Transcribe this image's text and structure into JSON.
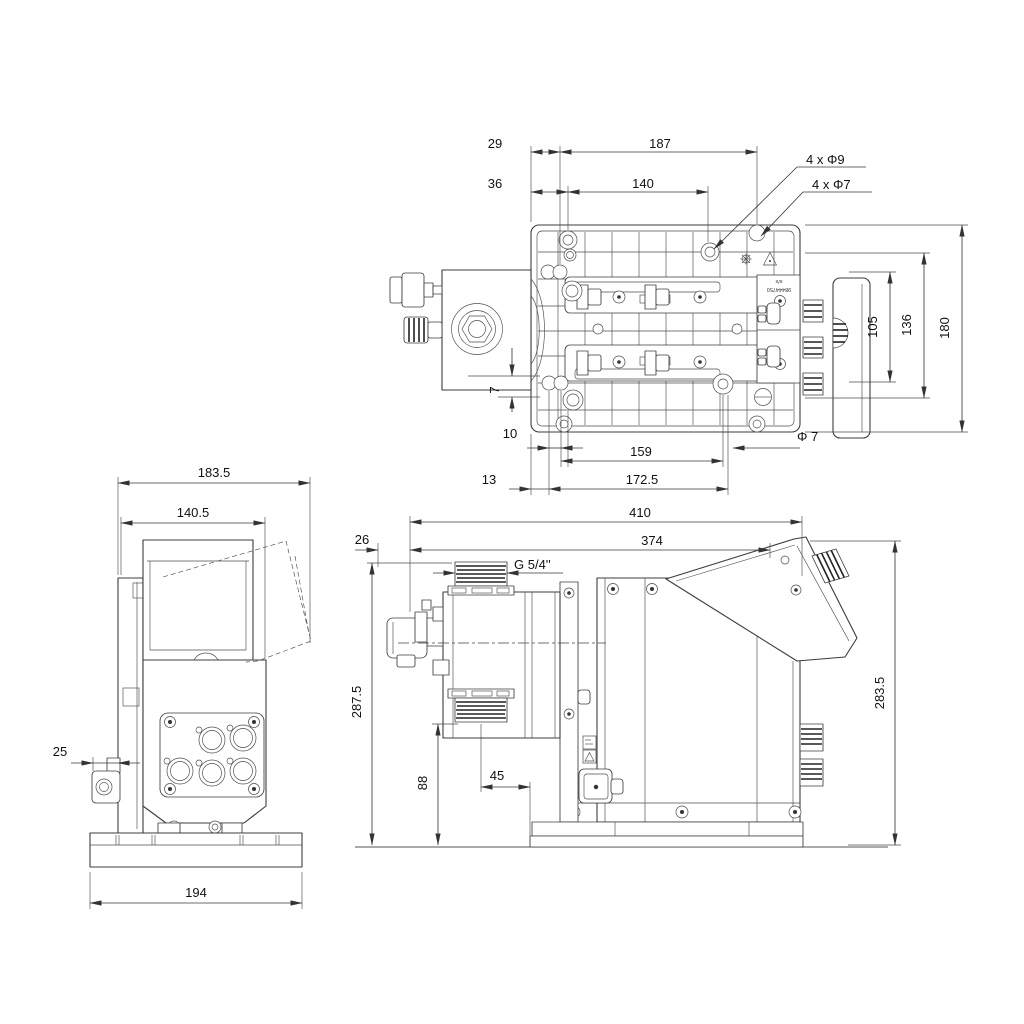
{
  "colors": {
    "background": "#ffffff",
    "line": "#3c3c3c",
    "text": "#111111"
  },
  "top": {
    "d29": "29",
    "d187": "187",
    "d36": "36",
    "d140": "140",
    "holes9": "4 x Φ9",
    "holes7": "4 x Φ7",
    "d105": "105",
    "d136": "136",
    "d180": "180",
    "d7": "7",
    "d10": "10",
    "d159": "159",
    "phi7": "Φ 7",
    "d13": "13",
    "d1725": "172.5",
    "mark1": "x/x",
    "mark2": "98444750"
  },
  "front": {
    "d1835": "183.5",
    "d1405": "140.5",
    "d25": "25",
    "d194": "194"
  },
  "side": {
    "d410": "410",
    "d26": "26",
    "d374": "374",
    "thread": "G 5/4''",
    "d2875": "287.5",
    "d88": "88",
    "d45": "45",
    "d2835": "283.5"
  }
}
